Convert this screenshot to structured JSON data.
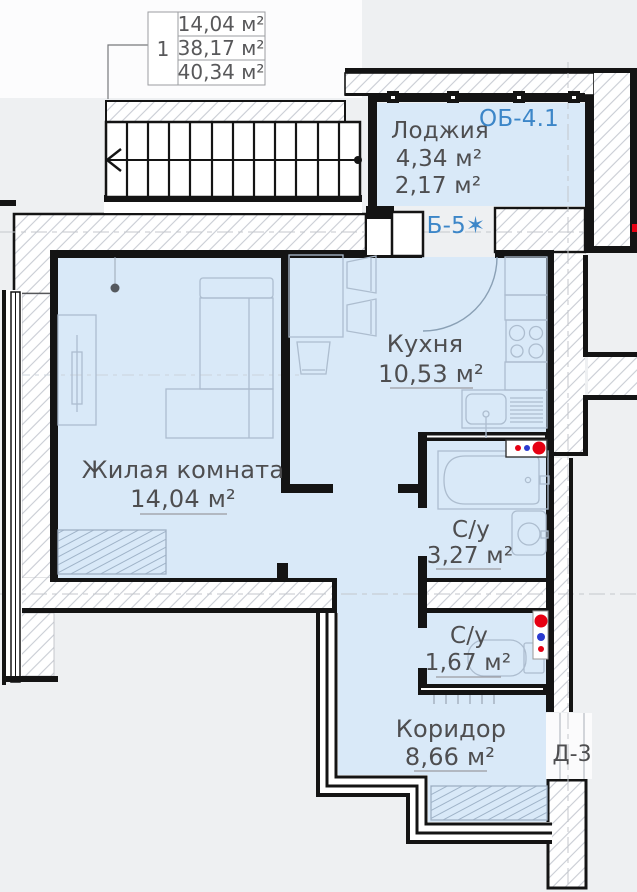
{
  "info_table": {
    "unit_number": "1",
    "areas": [
      "14,04 м²",
      "38,17 м²",
      "40,34 м²"
    ]
  },
  "rooms": {
    "loggia": {
      "name": "Лоджия",
      "area_full": "4,34 м²",
      "area_reduced": "2,17 м²"
    },
    "kitchen": {
      "name": "Кухня",
      "area": "10,53 м²"
    },
    "living": {
      "name": "Жилая комната",
      "area": "14,04 м²"
    },
    "bath1": {
      "name": "С/у",
      "area": "3,27 м²"
    },
    "bath2": {
      "name": "С/у",
      "area": "1,67 м²"
    },
    "corridor": {
      "name": "Коридор",
      "area": "8,66 м²"
    }
  },
  "marks": {
    "window_block_label": "ОБ-4.1",
    "balcony_door_label": "Б-5✶",
    "entry_door_label": "Д-3"
  },
  "colors": {
    "room_fill": "#d9e9f8",
    "wall": "#141414",
    "accent_blue": "#3c86c8",
    "text": "#4e4e50",
    "riser_red": "#e60012",
    "riser_blue": "#2b3bd0",
    "furniture_line": "#adbdcf"
  }
}
